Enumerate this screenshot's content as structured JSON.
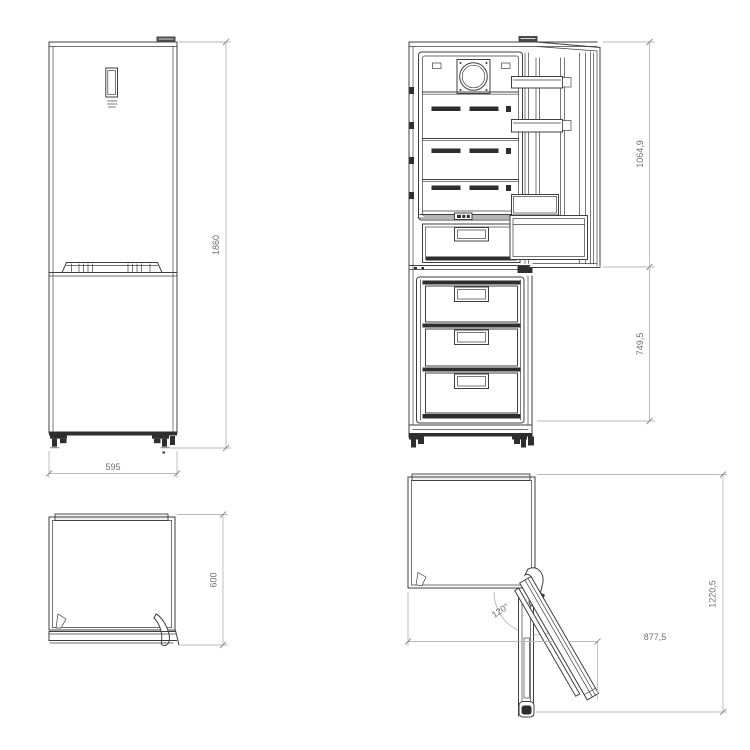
{
  "colors": {
    "line": "#3f3f3f",
    "dark": "#2e2e2e",
    "dim": "#b9b9b9",
    "label": "#6f6f6f",
    "bg": "#ffffff"
  },
  "views": {
    "front_closed": {
      "height_mm": "1860",
      "width_mm": "595"
    },
    "front_open": {
      "fridge_door_height_mm": "1064,9",
      "freezer_door_height_mm": "749,5"
    },
    "top_closed": {
      "depth_mm": "600"
    },
    "top_open": {
      "door_angle": "120°",
      "open_width_mm": "877,5",
      "open_depth_mm": "1220,5"
    }
  }
}
